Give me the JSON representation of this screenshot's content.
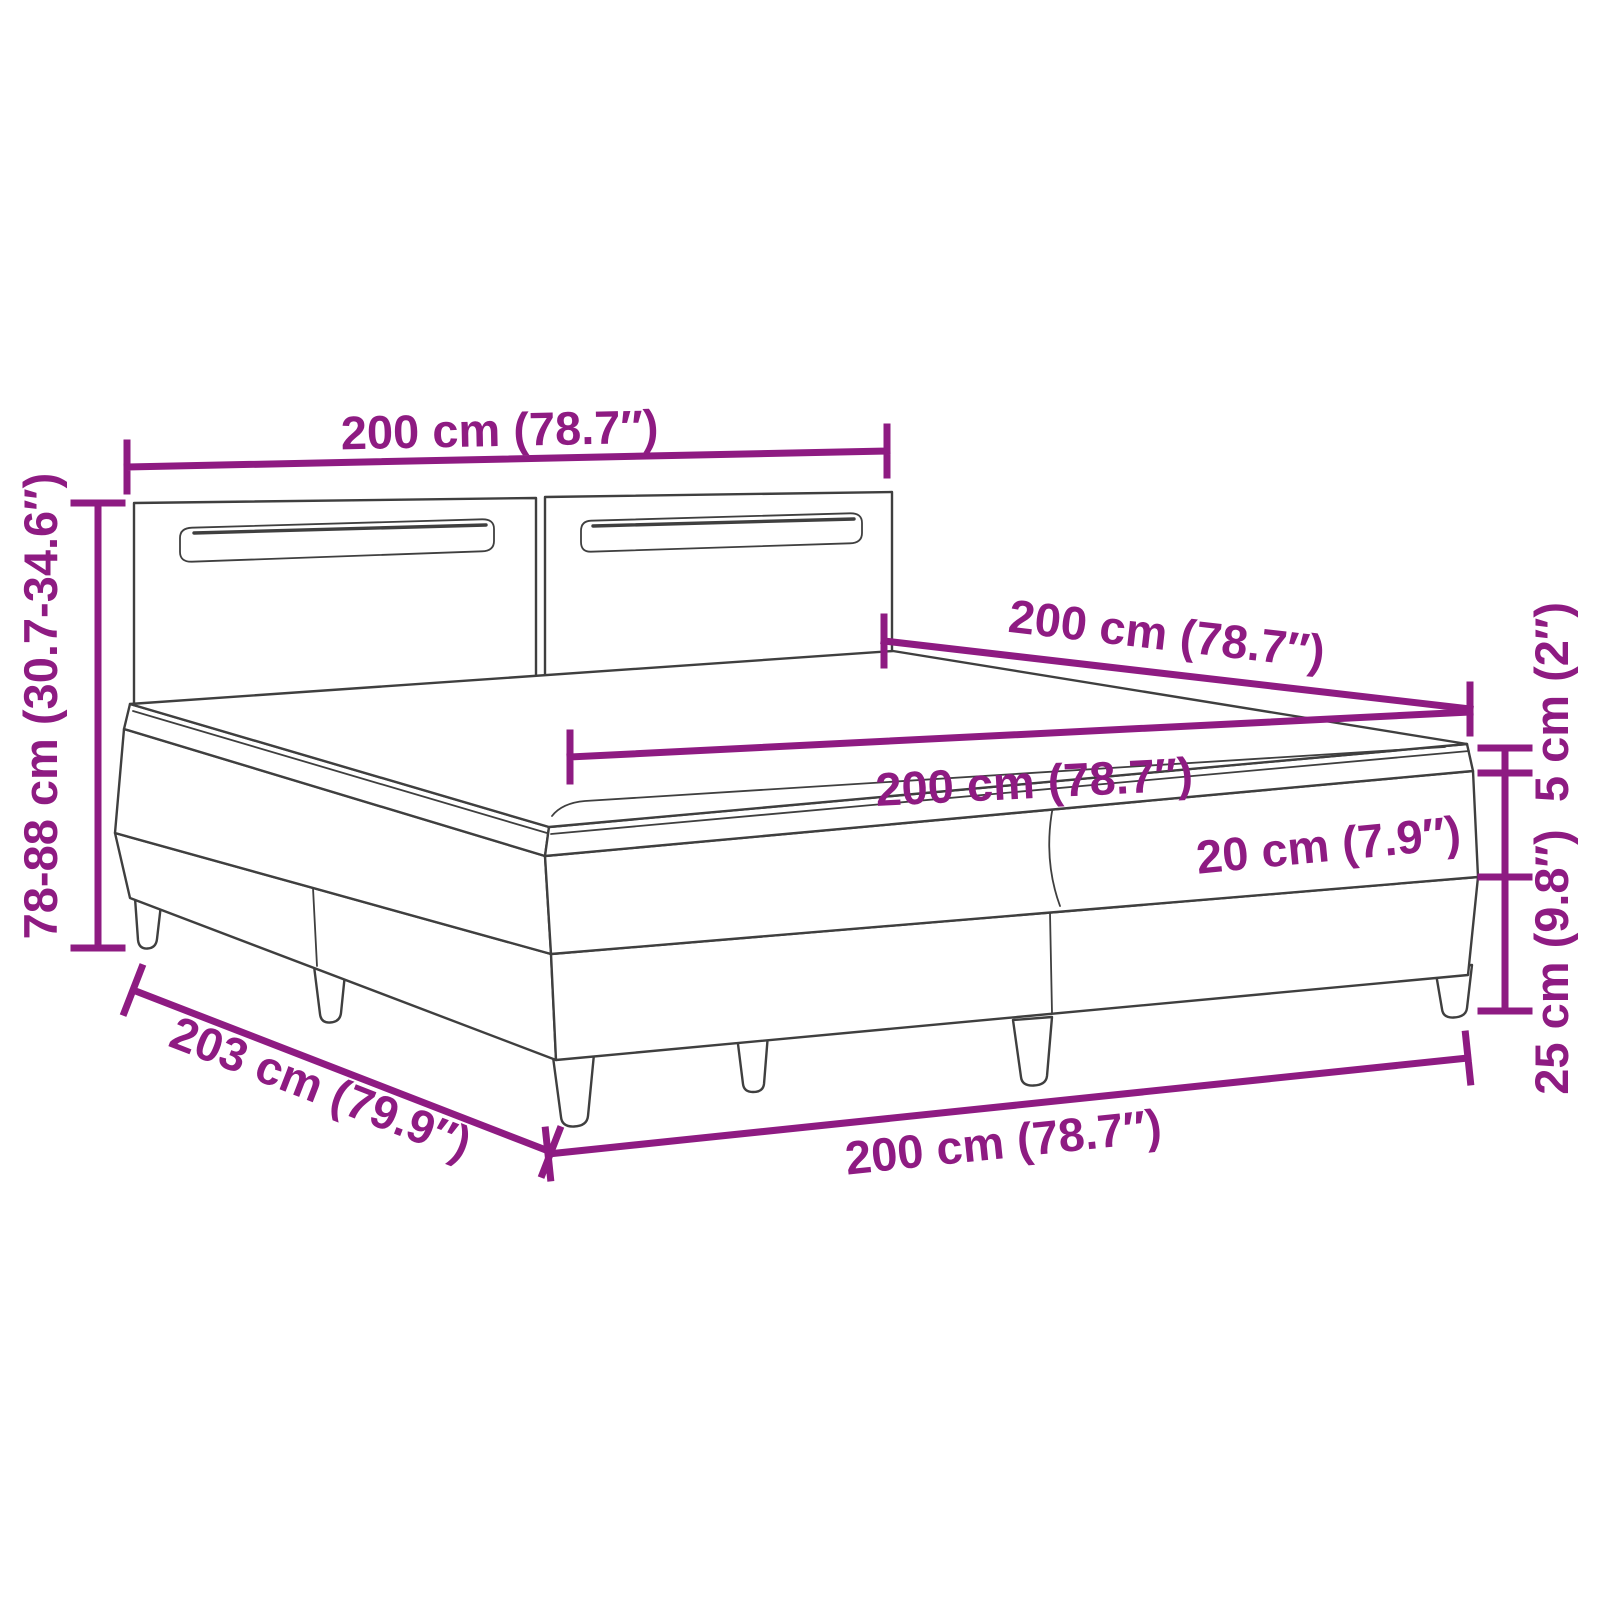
{
  "diagram": {
    "type": "product-dimension-diagram",
    "product": "box-spring-bed-with-led-headboard",
    "colors": {
      "accent": "#8E1B82",
      "line": "#3F3F3F",
      "background": "#FFFFFF"
    },
    "dimensions": {
      "headboard_width": "200 cm (78.7″)",
      "bed_depth": "200 cm (78.7″)",
      "mattress_width": "200 cm (78.7″)",
      "mattress_height": "20 cm (7.9″)",
      "topper_height": "5 cm (2″)",
      "base_height": "25 cm (9.8″)",
      "total_height": "78-88 cm (30.7-34.6″)",
      "total_length": "203 cm (79.9″)",
      "base_width": "200 cm (78.7″)"
    }
  }
}
